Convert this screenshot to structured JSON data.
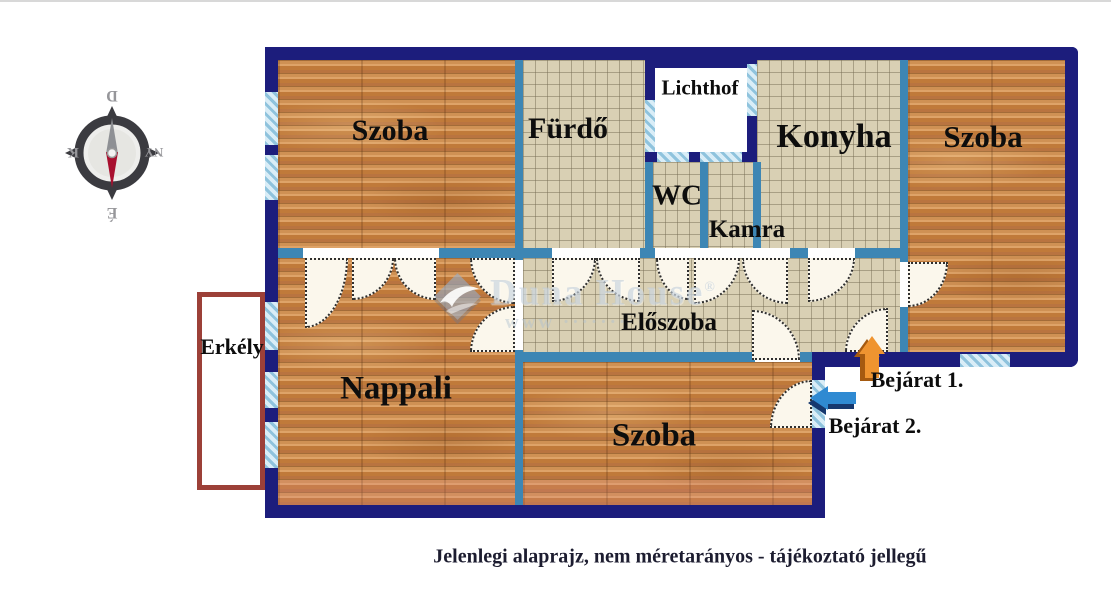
{
  "caption": "Jelenlegi alaprajz, nem méretarányos - tájékoztató jellegű",
  "compass": {
    "top": "D",
    "right": "NY",
    "bottom": "É",
    "left": "K"
  },
  "rooms": {
    "szoba_tl": "Szoba",
    "furdo": "Fürdő",
    "lichthof": "Lichthof",
    "wc": "WC",
    "kamra": "Kamra",
    "konyha": "Konyha",
    "szoba_tr": "Szoba",
    "eloszoba": "Előszoba",
    "nappali": "Nappali",
    "szoba_b": "Szoba",
    "erkely": "Erkély"
  },
  "entrances": {
    "bejarat1": "Bejárat 1.",
    "bejarat2": "Bejárat 2."
  },
  "watermark": {
    "brand": "Duna House",
    "reg": "®",
    "www": "www ············"
  },
  "colors": {
    "outer_wall": "#1c1d7c",
    "inner_wall": "#3d86b4",
    "window_fill": "#d9edf7",
    "window_stripe": "#8fc3dd",
    "wood_floor": "#c8894e",
    "tile_floor": "#d9d0b4",
    "balcony_border": "#9c4038",
    "entrance1_arrow": "#ef9430",
    "entrance2_arrow": "#2f8ad2",
    "compass_north_needle": "#a80f2e"
  }
}
